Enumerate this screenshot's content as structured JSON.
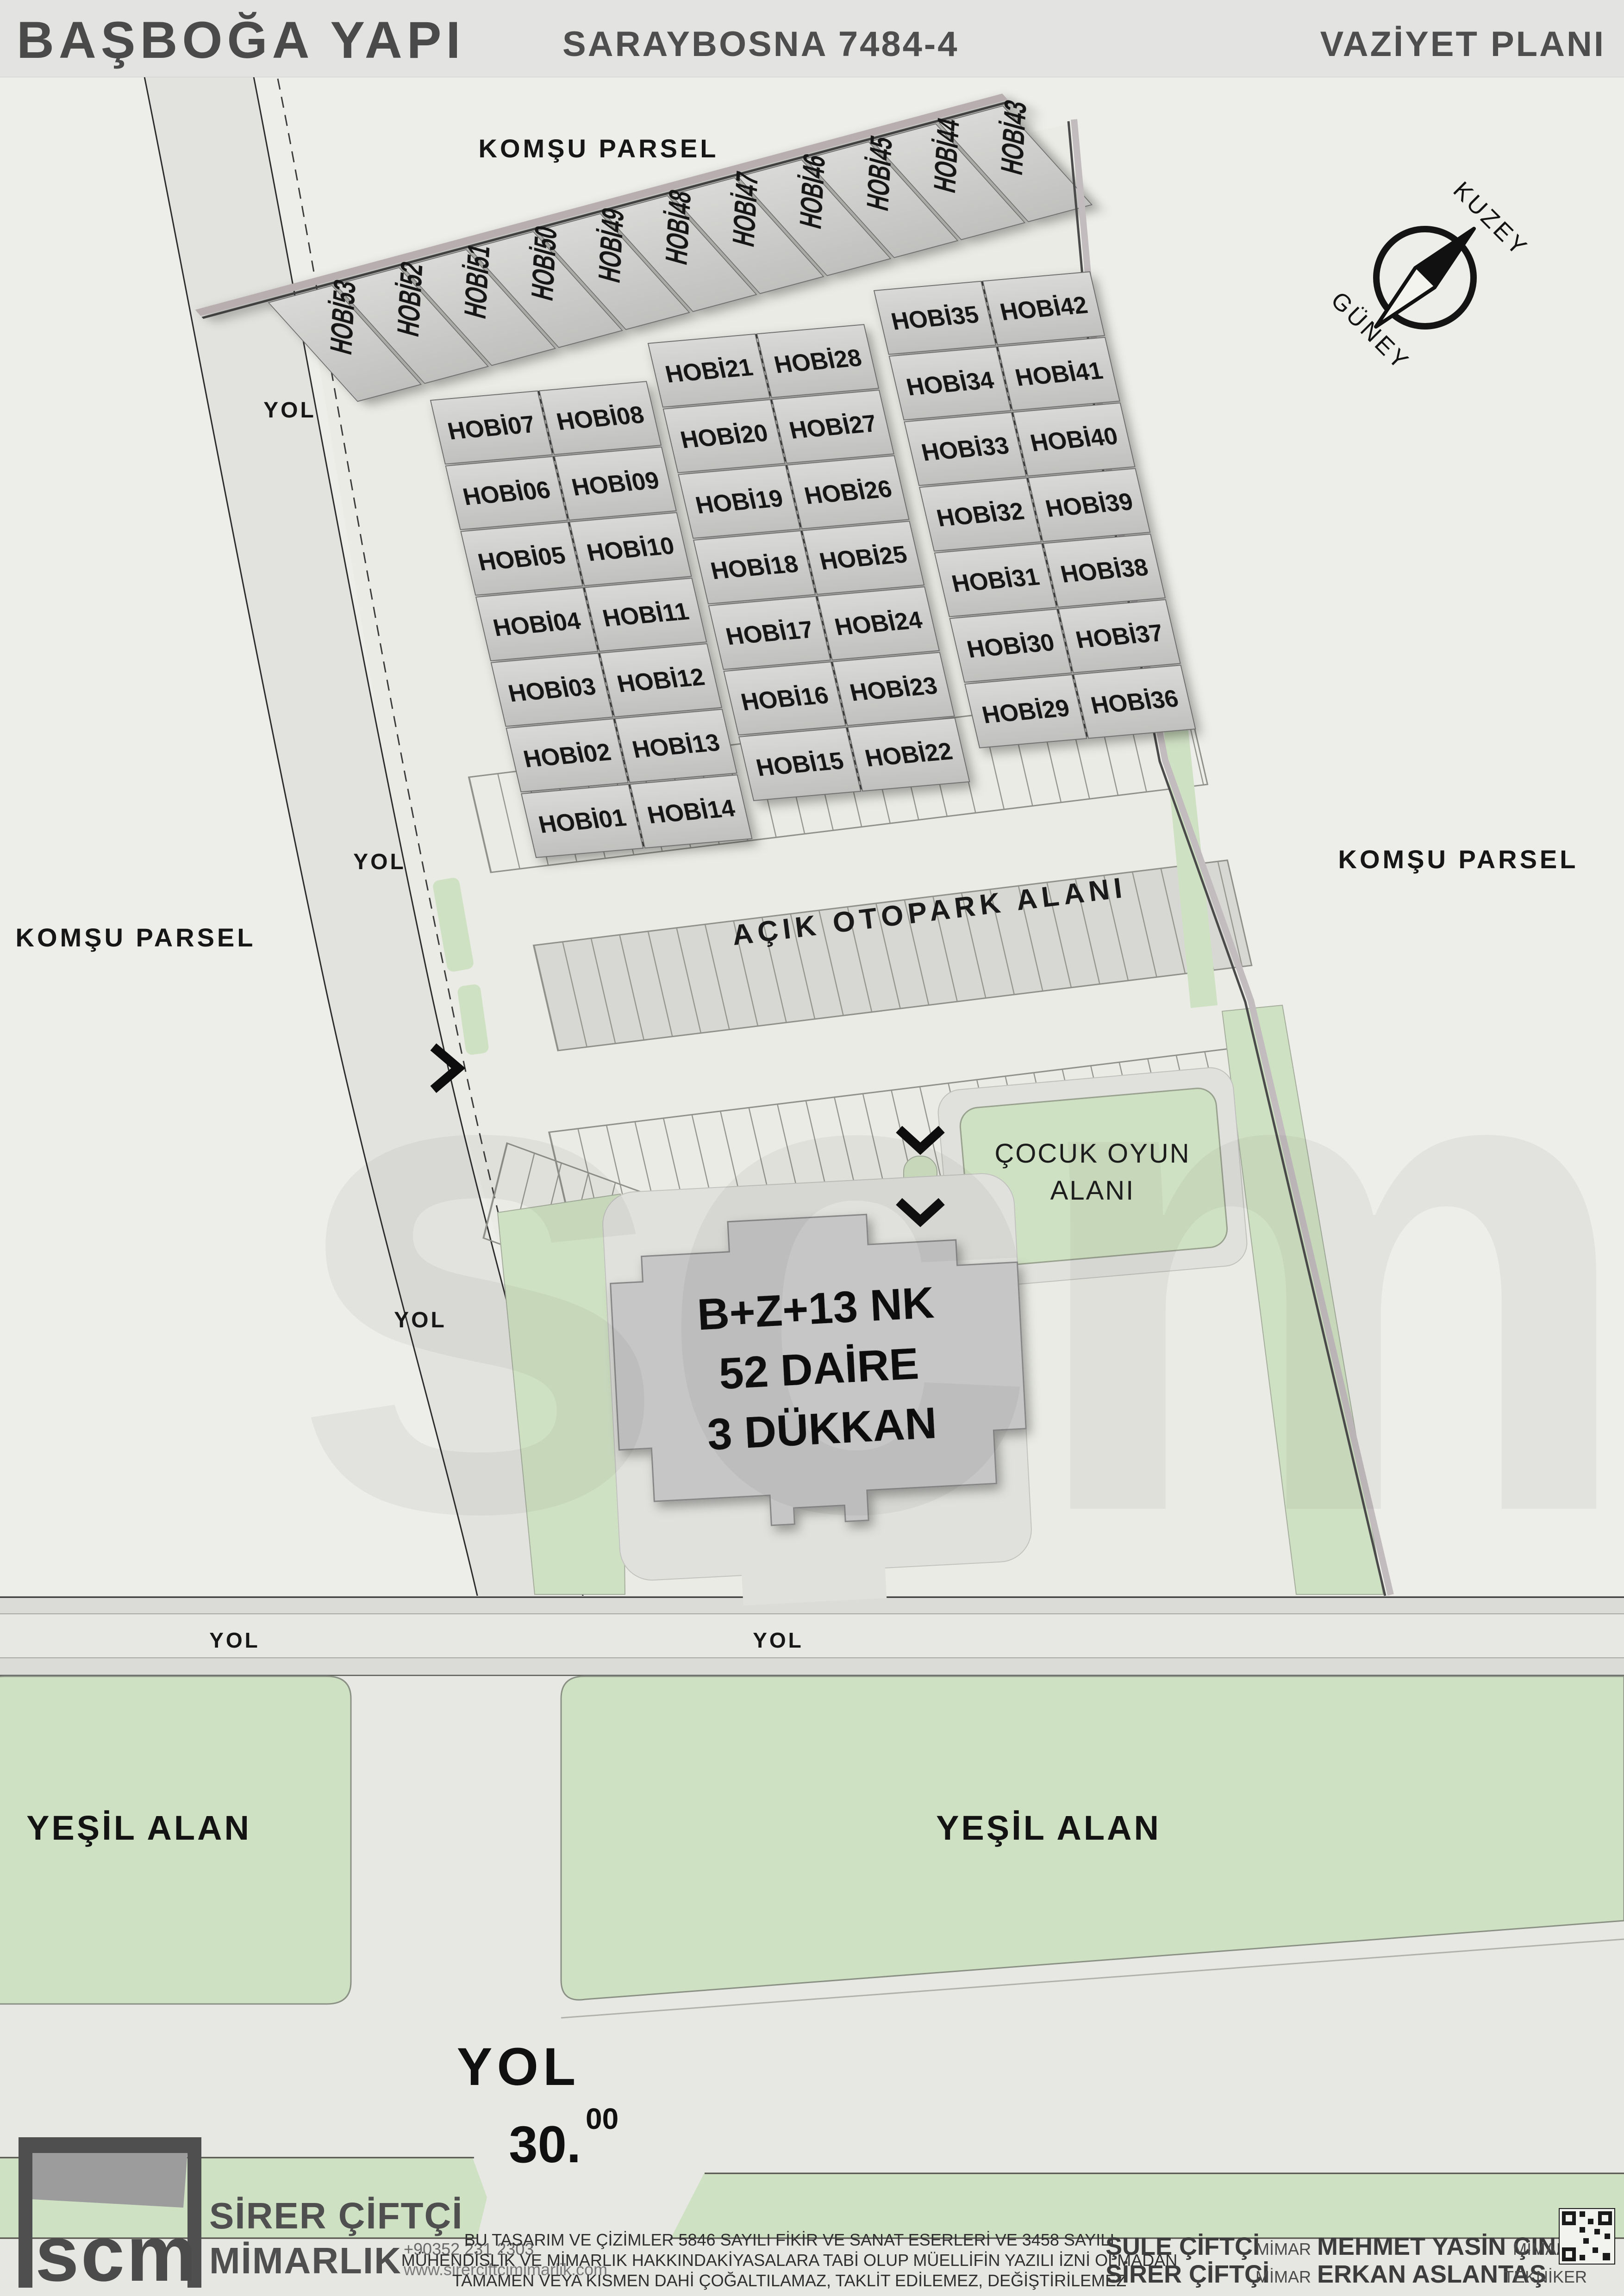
{
  "header": {
    "project": "BAŞBOĞA YAPI",
    "subtitle": "SARAYBOSNA 7484-4",
    "plan_type": "VAZİYET PLANI"
  },
  "compass": {
    "north": "KUZEY",
    "south": "GÜNEY"
  },
  "labels": {
    "neighbor_parcel": "KOMŞU PARSEL",
    "road": "YOL",
    "road_width_int": "30.",
    "road_width_sup": "00",
    "parking": "AÇIK OTOPARK ALANI",
    "playground_line1": "ÇOCUK OYUN",
    "playground_line2": "ALANI",
    "green_area": "YEŞİL ALAN"
  },
  "building": {
    "line1": "B+Z+13 NK",
    "line2": "52 DAİRE",
    "line3": "3 DÜKKAN"
  },
  "plots": {
    "strip": [
      "HOBİ53",
      "HOBİ52",
      "HOBİ51",
      "HOBİ50",
      "HOBİ49",
      "HOBİ48",
      "HOBİ47",
      "HOBİ46",
      "HOBİ45",
      "HOBİ44",
      "HOBİ43"
    ],
    "block1_left": [
      "HOBİ07",
      "HOBİ06",
      "HOBİ05",
      "HOBİ04",
      "HOBİ03",
      "HOBİ02",
      "HOBİ01"
    ],
    "block1_right": [
      "HOBİ08",
      "HOBİ09",
      "HOBİ10",
      "HOBİ11",
      "HOBİ12",
      "HOBİ13",
      "HOBİ14"
    ],
    "block2_left": [
      "HOBİ21",
      "HOBİ20",
      "HOBİ19",
      "HOBİ18",
      "HOBİ17",
      "HOBİ16",
      "HOBİ15"
    ],
    "block2_right": [
      "HOBİ28",
      "HOBİ27",
      "HOBİ26",
      "HOBİ25",
      "HOBİ24",
      "HOBİ23",
      "HOBİ22"
    ],
    "block3_left": [
      "HOBİ35",
      "HOBİ34",
      "HOBİ33",
      "HOBİ32",
      "HOBİ31",
      "HOBİ30",
      "HOBİ29"
    ],
    "block3_right": [
      "HOBİ42",
      "HOBİ41",
      "HOBİ40",
      "HOBİ39",
      "HOBİ38",
      "HOBİ37",
      "HOBİ36"
    ]
  },
  "watermark": "scm",
  "footer": {
    "firm_abbrev": "scm",
    "firm_line1": "SİRER ÇİFTÇİ",
    "firm_line2": "MİMARLIK",
    "phone": "+90352 231 2303",
    "website": "www.sirerciftcimimarlik.com",
    "legal_line1": "BU TASARIM VE ÇİZİMLER 5846 SAYILI FİKİR VE SANAT ESERLERİ VE 3458 SAYILI",
    "legal_line2": "MÜHENDİSLİK VE MİMARLIK HAKKINDAKİYASALARA TABİ OLUP MÜELLİFİN YAZILI İZNİ OLMADAN",
    "legal_line3": "TAMAMEN VEYA KISMEN DAHİ ÇOĞALTILAMAZ, TAKLİT EDİLEMEZ, DEĞİŞTİRİLEMEZ",
    "credits": [
      {
        "name": "ŞULE ÇİFTÇİ",
        "title": "MİMAR"
      },
      {
        "name": "MEHMET YASİN ÇINAR",
        "title": "MİMAR"
      },
      {
        "name": "SİRER ÇİFTÇİ",
        "title": "MİMAR"
      },
      {
        "name": "ERKAN ASLANTAŞ",
        "title": "TEKNİKER"
      }
    ]
  },
  "colors": {
    "green": "#cfe1c3",
    "road_fill": "#e2e3df",
    "plot_fill": "#c9c9c9",
    "line_dark": "#2c2c2c",
    "wall_light": "#b8aeb0"
  }
}
